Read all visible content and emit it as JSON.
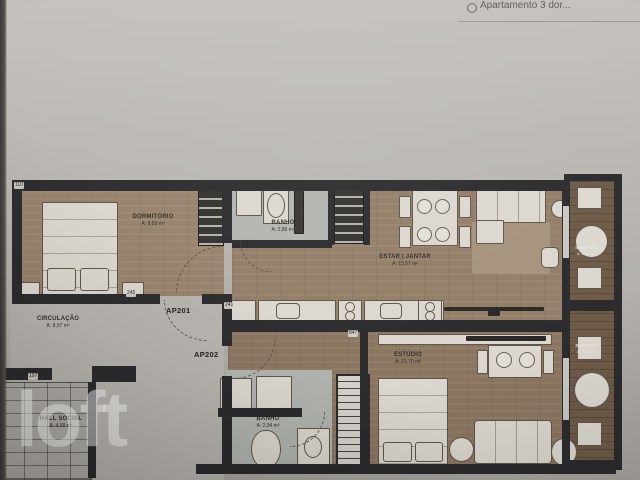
{
  "header": {
    "title": "Apartamento 3 dor...",
    "icon": "listing-icon"
  },
  "watermark": {
    "brand": "loft"
  },
  "floorplan": {
    "units": [
      {
        "label": "AP201"
      },
      {
        "label": "AP202"
      }
    ],
    "rooms": [
      {
        "name": "DORMITÓRIO",
        "area": "A: 8,53 m²"
      },
      {
        "name": "BANHO",
        "area": "A: 2,86 m²"
      },
      {
        "name": "ESTAR | JANTAR",
        "area": "A: 15,57 m²"
      },
      {
        "name": "CIRCULAÇÃO",
        "area": "A: 8,97 m²"
      },
      {
        "name": "ESTÚDIO",
        "area": "A: 21,70 m²"
      },
      {
        "name": "BANHO",
        "area": "A: 2,94 m²"
      },
      {
        "name": "SACADA",
        "area": "A: 3,05 m²"
      },
      {
        "name": "SACADA",
        "area": "A: 3,05 m²"
      },
      {
        "name": "HALL SOCIAL",
        "area": "A: 4,58 m²"
      }
    ],
    "dimensions": [
      "110",
      "245",
      "241",
      "847",
      "197"
    ]
  },
  "colors": {
    "wall": "#2c2b2d",
    "wood_floor": "#937e67",
    "balcony_deck": "#6e5b48",
    "tile_floor": "#b6b4af",
    "background": "#b9b6b1",
    "watermark": "#ffffff"
  }
}
